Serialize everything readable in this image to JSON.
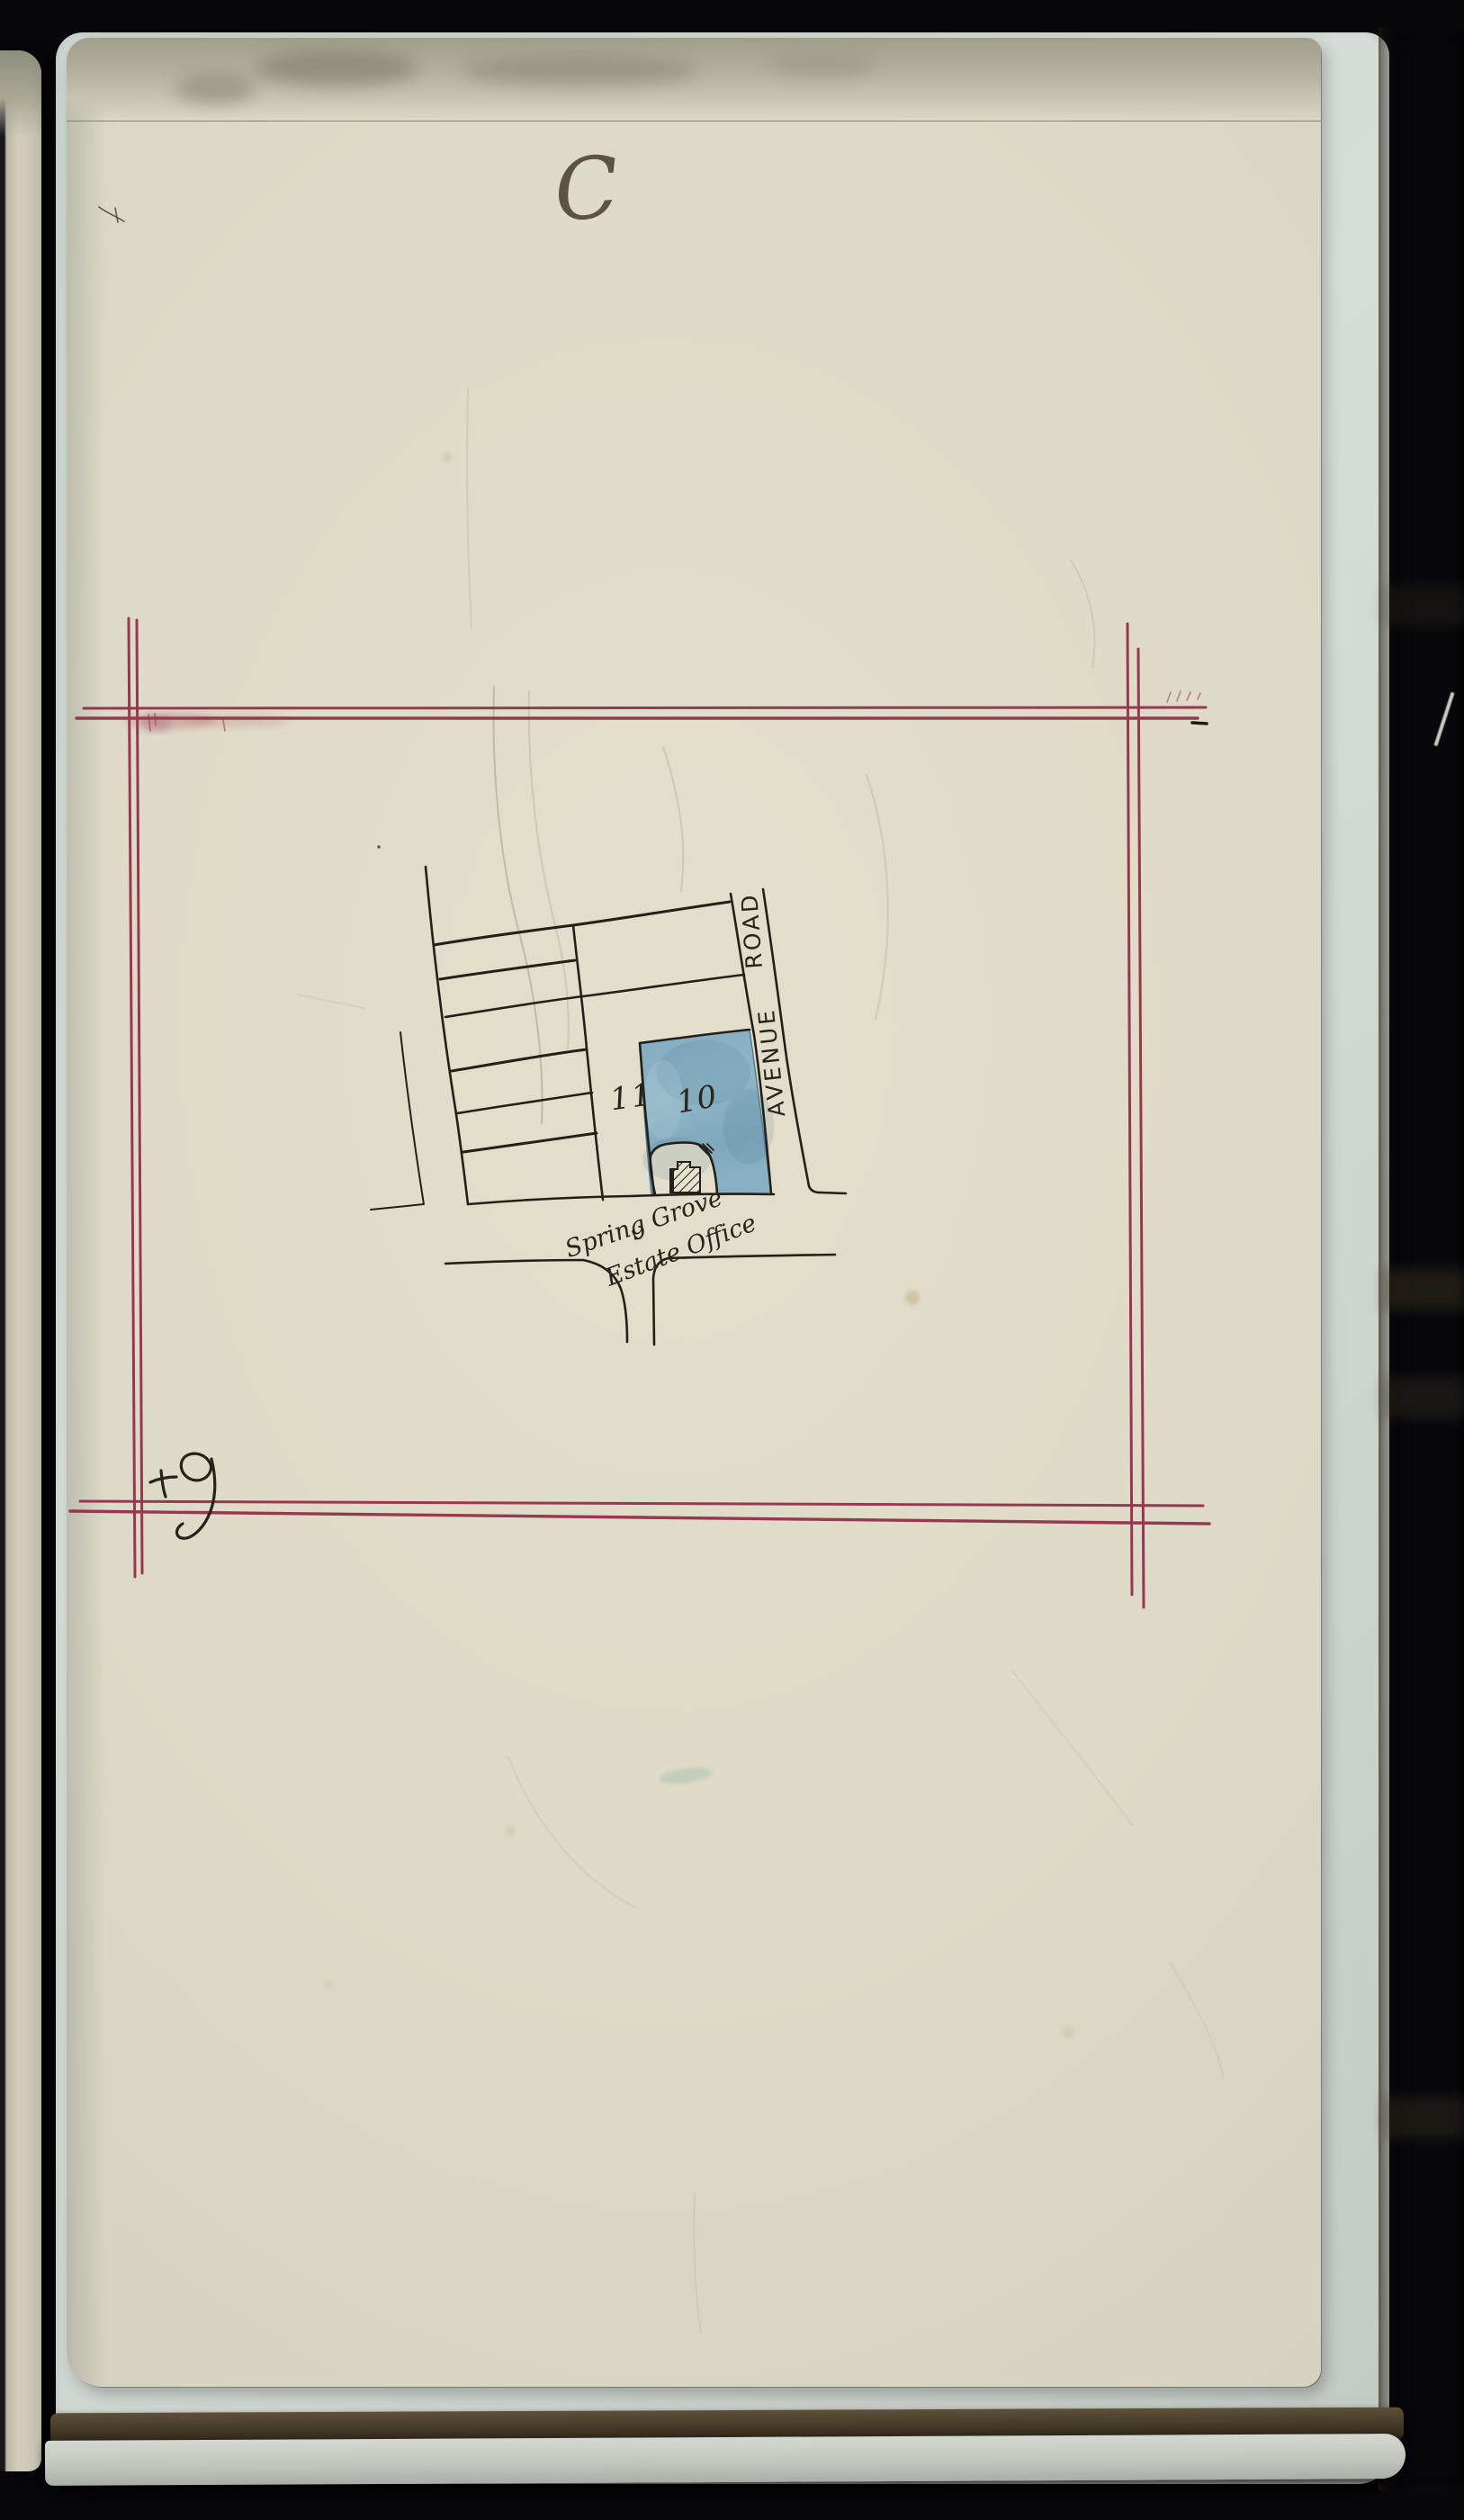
{
  "document": {
    "index_letter": "C",
    "map": {
      "road": {
        "name": "AVENUE ROAD",
        "word_lower": "AVENUE",
        "word_upper": "ROAD"
      },
      "parcels": [
        {
          "number": "11",
          "fill": "none"
        },
        {
          "number": "10",
          "fill": "blue-wash"
        }
      ],
      "office_label": {
        "line1": "Spring Grove",
        "line2": "Estate Office"
      }
    },
    "marks": {
      "bottom_left_scribble": "plus-nine-scribble-icon",
      "top_right_dash": "ink-dash-icon",
      "top_left_speck": "ink-speck-icon"
    },
    "colors": {
      "frame_red": "#93304a",
      "parcel_blue": "#8fb4c6",
      "ink": "#241f17",
      "page_cream": "#dfdbc8",
      "backing_page": "#ccd4ce",
      "fore_edge_brown": "#84734f"
    }
  }
}
